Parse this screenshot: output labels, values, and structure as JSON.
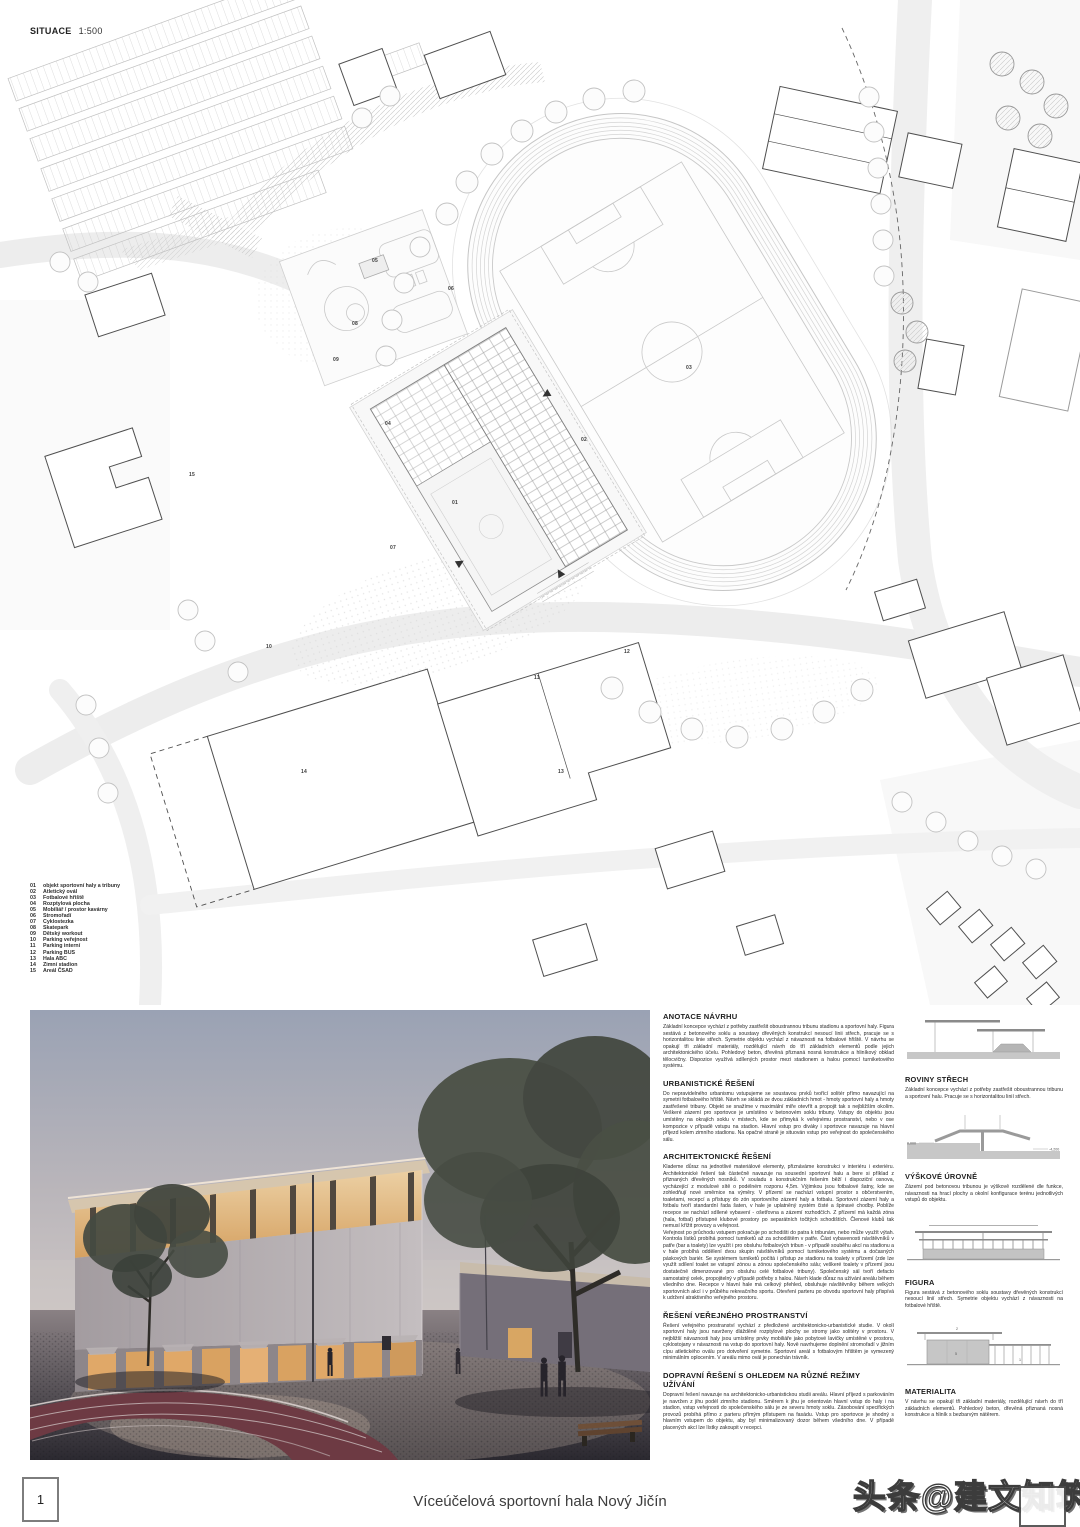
{
  "plan": {
    "title": "SITUACE",
    "scale": "1:500",
    "labels": [
      "01",
      "02",
      "03",
      "04",
      "05",
      "06",
      "07",
      "08",
      "09",
      "10",
      "11",
      "12",
      "13",
      "14",
      "15"
    ]
  },
  "legend": {
    "items": [
      {
        "num": "01",
        "label": "objekt sportovní haly a tribuny"
      },
      {
        "num": "02",
        "label": "Atletický ovál"
      },
      {
        "num": "03",
        "label": "Fotbalové hřiště"
      },
      {
        "num": "04",
        "label": "Rozptylová plocha"
      },
      {
        "num": "05",
        "label": "Mobiliář / prostor kavárny"
      },
      {
        "num": "06",
        "label": "Stromořadí"
      },
      {
        "num": "07",
        "label": "Cyklostezka"
      },
      {
        "num": "08",
        "label": "Skatepark"
      },
      {
        "num": "09",
        "label": "Dětský workout"
      },
      {
        "num": "10",
        "label": "Parking veřejnost"
      },
      {
        "num": "11",
        "label": "Parking interní"
      },
      {
        "num": "12",
        "label": "Parking BUS"
      },
      {
        "num": "13",
        "label": "Hala ABC"
      },
      {
        "num": "14",
        "label": "Zimní stadion"
      },
      {
        "num": "15",
        "label": "Areál ČSAD"
      }
    ]
  },
  "annotations": {
    "sections": [
      {
        "title": "ANOTACE NÁVRHU",
        "body": "Základní koncepce vychází z potřeby zastřešit oboustrannou tribunu stadionu a sportovní haly. Figura sestává z betonového soklu a soustavy dřevěných konstrukcí nesoucí linii střech, pracuje se s horizontalitou linie střech. Symetrie objektu vychází z návaznosti na fotbalové hřiště. V návrhu se opakují tři základní materiály, rozdělující návrh do tří základních elementů podle jejich architektonického účelu. Pohledový beton, dřevěná přiznaná nosná konstrukce a hliníkový obklad tělocvičny. Dispozice využívá sdílených prostor mezi stadionem a halou pomocí turniketového systému."
      },
      {
        "title": "URBANISTICKÉ ŘEŠENÍ",
        "body": "Do nepravidelného urbanismu vstupujeme se soustavou prvků tvořící solitér přímo navazující na symetrii fotbalového hřiště. Návrh se skládá ze dvou základních hmot - hmoty sportovní haly a hmoty zastřešené tribuny. Objekt se snažíme v maximální míře otevřít a propojit tak s nejbližším okolím. Veškeré zázemí pro sportovce je umístěno v betonovém soklu tribuny. Vstupy do objektu jsou umístěny na okrajích soklu v místech, kde se přimyká k veřejnému prostranství, nebo v ose kompozice v případě vstupu na stadion. Hlavní vstup pro diváky i sportovce navazuje na hlavní příjezd kolem zimního stadionu. Na opačné straně je situován vstup pro veřejnost do společenského sálu."
      },
      {
        "title": "ARCHITEKTONICKÉ ŘEŠENÍ",
        "body": "Klademe důraz na jednotlivé materiálové elementy, přiznáváme konstrukci v interiéru i exteriéru. Architektonické řešení tak částečně navazuje na sousední sportovní halu a bere si příklad z přiznaných dřevěných nosníků. V souladu s konstrukčním řešením běží i dispoziční osnova, vycházející z modulové sítě o podélném rozponu 4,5m. Výjimkou jsou fotbalové šatny, kde se zohledňují nové směrnice na výměry. V přízemí se nachází vstupní prostor s občerstvením, toaletami, recepcí a přístupy do zón sportovního zázemí haly a fotbalu. Sportovní zázemí haly a fotbalu tvoří standardní řada šaten, v hale je uplatněný systém čisté a špinavé chodby. Poblíže recepce se nachází sdílené vybavení - ošetřovna a zázemí rozhodčích. Z přízemí má každá zóna (hala, fotbal) přístupné klubové prostory po separátních točitých schodištích. Členové klubů tak nemusí křížit provozy a veřejnost.\nVeřejnost po průchodu vstupem pokračuje po schodišti do patra k tribunám, nebo může využít výtah. Kontrola lístků probíhá pomocí turniketů až za schodištěm v patře. Část vybavenosti návštěvníků v patře (bar a toalety) lze využít i pro obsluhu fotbalových tribun - v případě souběhu akcí na stadionu a v hale probíhá oddělení dvou skupin návštěvníků pomocí turniketového systému a dočasných páskových bariér. Se systémem turniketů počítá i přístup ze stadionu na toalety v přízemí (zde lze využít sdílení toalet se vstupní zónou a zónou společenského sálu; veškeré toalety v přízemí jsou dostatečně dimenzované pro obsluhu celé fotbalové tribuny). Společenský sál tvoří defacto samostatný celek, propojitelný v případě potřeby s halou. Návrh klade důraz na užívání areálu během všedního dne. Recepce v hlavní hale má celkový přehled, obsluhuje návštěvníky během velkých sportovních akcí i v průběhu rekreačního sportu. Otevření parteru po obvodu sportovní haly přispívá k udržení atraktivního veřejného prostoru."
      },
      {
        "title": "ŘEŠENÍ VEŘEJNÉHO PROSTRANSTVÍ",
        "body": "Řešení veřejného prostranství vychází z předložené architektonicko-urbanistické studie. V okolí sportovní haly jsou navrženy dlážděné rozptylové plochy se stromy jako solitéry v prostoru. V nejbližší návaznosti haly jsou umístěny prvky mobiliáře jako pobytové lavičky umístěné v prostoru, cyklostojany v návaznosti na vstup do sportovní haly. Nově navrhujeme doplnění stromořadí v jižním cípu atletického oválu pro dotvoření symetrie. Sportovní areál s fotbalovým hřištěm je vymezený minimálním oplocením. V areálu mimo ovál je ponechán trávník."
      },
      {
        "title": "DOPRAVNÍ ŘEŠENÍ S OHLEDEM NA RŮZNÉ REŽIMY UŽÍVÁNÍ",
        "body": "Dopravní řešení navazuje na architektonicko-urbanistickou studii areálu. Hlavní příjezd s parkováním je navržen z jihu podél zimního stadionu. Směrem k jihu je orientován hlavní vstup do haly i na stadion, vstup veřejnosti do společenského sálu je ze severu hmoty soklu. Zásobování specifických provozů probíhá přímo z parteru přímým přístupem na fasádu. Vstup pro sportovce je shodný s hlavním vstupem do objektu, aby byl minimalizovaný dozor během všedního dne. V případě placených akcí lze lístky zakoupit v recepci."
      }
    ]
  },
  "diagrams": {
    "items": [
      {
        "title": "ROVINY STŘECH",
        "body": "Základní koncepce vychází z potřeby zastřešit oboustrannou tribunu a sportovní halu. Pracuje se s horizontalitou linií střech."
      },
      {
        "title": "VÝŠKOVÉ ÚROVNĚ",
        "body": "Zázemí pod betonovou tribunou je výškově rozdělené dle funkce, návaznosti na hrací plochy a okolní konfigurace terénu jednotlivých vstupů do objektu.",
        "levels": {
          "left": "0,000",
          "right": "-4,200"
        }
      },
      {
        "title": "FIGURA",
        "body": "Figura sestává z betonového soklu soustavy dřevěných konstrukcí nesoucí linií střech. Symetrie objektu vychází z návaznosti na fotbalové hřiště."
      },
      {
        "title": "MATERIALITA",
        "body": "V návrhu se opakují tři základní materiály, rozdělující návrh do tří základních elementů. Pohledový beton, dřevěná přiznaná nosná konstrukce a hliník s bezbarvým nátěrem.",
        "callouts": [
          "2",
          "5",
          "1"
        ]
      }
    ]
  },
  "footer": {
    "page_number": "1",
    "title": "Víceúčelová sportovní hala Nový Jičín"
  },
  "watermark": {
    "text": "头条@建文知筑"
  },
  "colors": {
    "plan_line": "#cfcfcf",
    "building_outline": "#4f4f4f",
    "track_red": "#6d3a43",
    "render_glow": "#d9a765",
    "render_sky_top": "#9aa2b4"
  }
}
